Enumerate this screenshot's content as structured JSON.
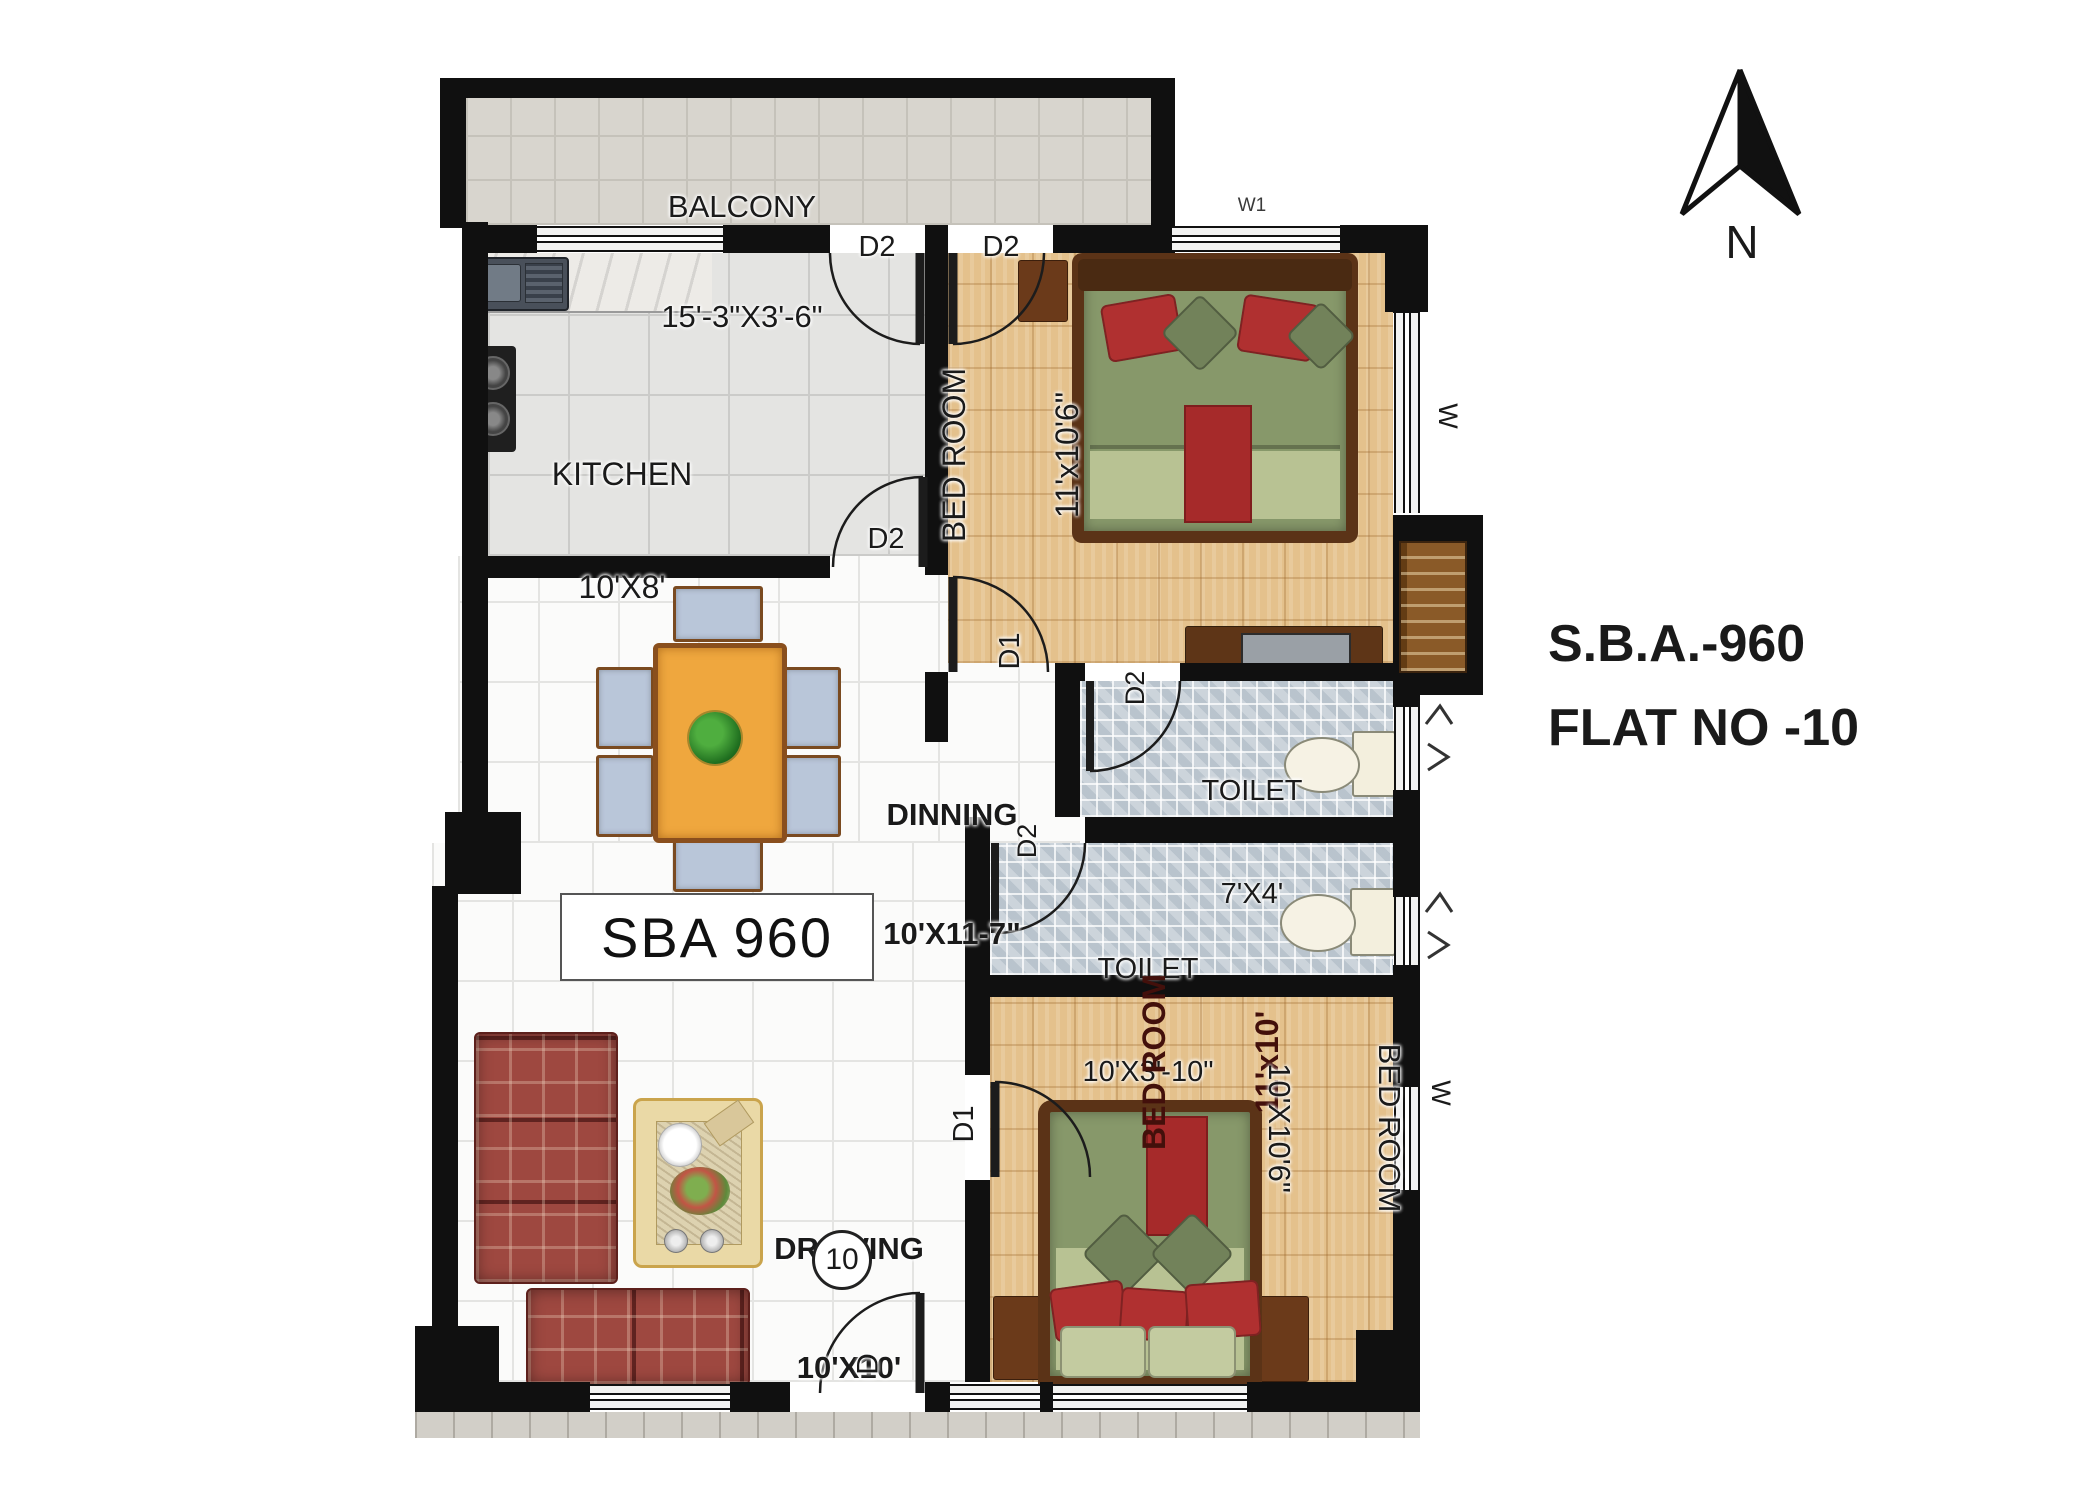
{
  "title_block": {
    "sba": "S.B.A.-960",
    "flat_no": "FLAT NO -10"
  },
  "compass": {
    "north_label": "N"
  },
  "rooms": {
    "balcony": {
      "name": "BALCONY",
      "dims": "15'-3\"X3'-6\""
    },
    "kitchen": {
      "name": "KITCHEN",
      "dims": "10'X8'"
    },
    "bedroom_top": {
      "name": "BED ROOM",
      "dims": "11'x10'6\""
    },
    "dining": {
      "name": "DINNING",
      "dims": "10'X11-7\""
    },
    "toilet_attached": {
      "name": "TOILET",
      "dims": "7'X4'"
    },
    "toilet_common": {
      "name": "TOILET",
      "dims": "10'X3'-10\""
    },
    "bedroom_middle": {
      "name": "BED ROOM",
      "dims": "11'x10'"
    },
    "bedroom_right": {
      "name": "BED ROOM",
      "dims": "10'X10'6\""
    },
    "drawing": {
      "name": "DRAWING",
      "dims": "10'X10'"
    }
  },
  "area_box": {
    "label": "SBA 960"
  },
  "flat_circle": {
    "number": "10"
  },
  "doors": {
    "balcony_kitchen": "D2",
    "balcony_bedroom": "D2",
    "kitchen_dining": "D2",
    "bedroom_top_entry": "D1",
    "toilet_attached_entry": "D2",
    "toilet_common_entry": "D2",
    "bedroom_lower_entry": "D1",
    "main_entrance": "D"
  },
  "windows": {
    "top_bedroom_head": "W1",
    "bedroom_top_side": "W",
    "bedroom_right_side": "W"
  },
  "colors": {
    "wall": "#101010",
    "parquet": "#e4c18c",
    "toilet_tile": "#ccd4db",
    "balcony_tile": "#d8d5ce",
    "sofa": "#9e4840",
    "bed_green": "#87986a",
    "accent_red": "#a62a2a",
    "label_maroon": "#43100b"
  }
}
